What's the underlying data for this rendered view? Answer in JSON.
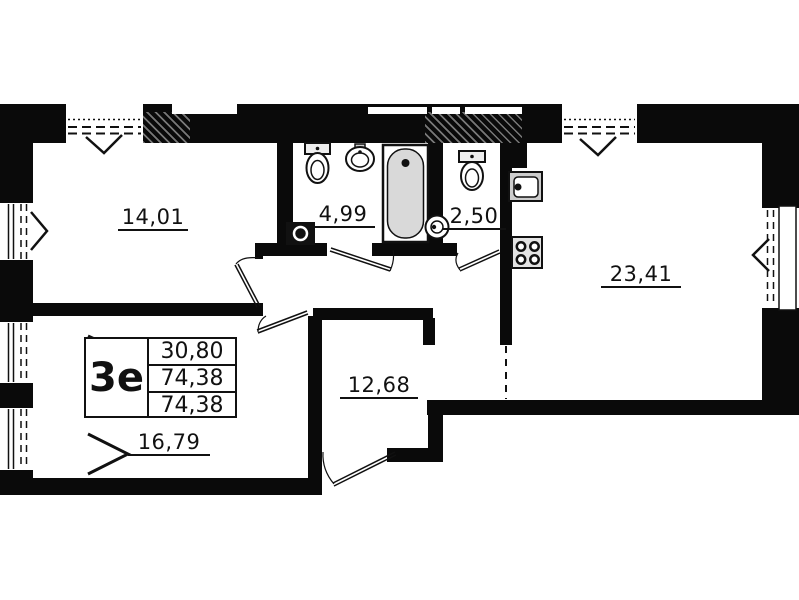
{
  "floor_plan": {
    "unit": {
      "type_label": "3е",
      "area_values": [
        "30,80",
        "74,38",
        "74,38"
      ]
    },
    "rooms": [
      {
        "name": "room-1",
        "area": "14,01"
      },
      {
        "name": "bathroom",
        "area": "4,99"
      },
      {
        "name": "wc",
        "area": "2,50"
      },
      {
        "name": "kitchen-living-room",
        "area": "23,41"
      },
      {
        "name": "hallway",
        "area": "12,68"
      },
      {
        "name": "room-2",
        "area": "16,79"
      }
    ],
    "colors": {
      "wall": "#0a0a0a",
      "fixture_fill": "#d9d9d9",
      "background": "#ffffff"
    }
  }
}
